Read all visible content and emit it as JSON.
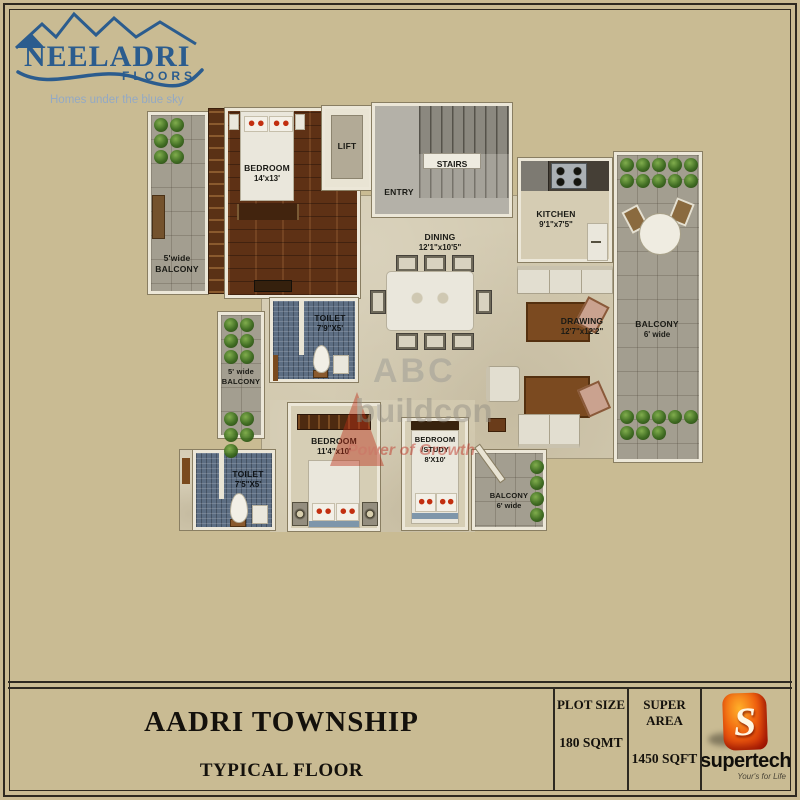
{
  "logo": {
    "brand": "NEELADRI",
    "sub": "FLOORS",
    "tagline": "Homes under the blue sky"
  },
  "rooms": {
    "balcony_top_left": {
      "l1": "5'wide",
      "l2": "BALCONY"
    },
    "bedroom1": {
      "l1": "BEDROOM",
      "l2": "14'x13'"
    },
    "lift": {
      "l1": "LIFT"
    },
    "stairs": {
      "l1": "STAIRS"
    },
    "entry": {
      "l1": "ENTRY"
    },
    "kitchen": {
      "l1": "KITCHEN",
      "l2": "9'1\"x7'5\""
    },
    "dining": {
      "l1": "DINING",
      "l2": "12'1\"x10'5\""
    },
    "drawing": {
      "l1": "DRAWING",
      "l2": "12'7\"x12'2\""
    },
    "balcony_right": {
      "l1": "BALCONY",
      "l2": "6' wide"
    },
    "toilet1": {
      "l1": "TOILET",
      "l2": "7'9\"X5'"
    },
    "balcony_mid_left": {
      "l1": "5' wide",
      "l2": "BALCONY"
    },
    "bedroom2": {
      "l1": "BEDROOM",
      "l2": "11'4\"x10'"
    },
    "bedroom3": {
      "l1": "BEDROOM",
      "l2": "/STUDY",
      "l3": "8'X10'"
    },
    "toilet2": {
      "l1": "TOILET",
      "l2": "7'5\"X5'"
    },
    "balcony_bottom": {
      "l1": "BALCONY",
      "l2": "6' wide"
    }
  },
  "watermark": {
    "l1": "ABC",
    "l2": "buildcon",
    "l3": "Power of Growth"
  },
  "footer": {
    "title": "AADRI TOWNSHIP",
    "subtitle": "TYPICAL FLOOR",
    "plot_size_label": "PLOT SIZE",
    "plot_size_value": "180 SQMT",
    "super_area_label": "SUPER AREA",
    "super_area_value": "1450 SQFT",
    "brand_letter": "S",
    "brand_name": "supertech",
    "brand_tagline": "Your's for Life"
  },
  "colors": {
    "page_bg": "#c9bb93",
    "line": "#2d2920",
    "logo_blue": "#2b5c8e",
    "logo_tagline": "#93a9c4",
    "wood": "#5e3115",
    "toilet_tile": "#5d6e83",
    "balcony_tile": "#a39e90",
    "plant_green": "#3c6b1e",
    "floor": "#d2c9af",
    "wall": "#ece7d8",
    "brand_red": "#d2250b",
    "watermark_red": "#c0392b"
  }
}
